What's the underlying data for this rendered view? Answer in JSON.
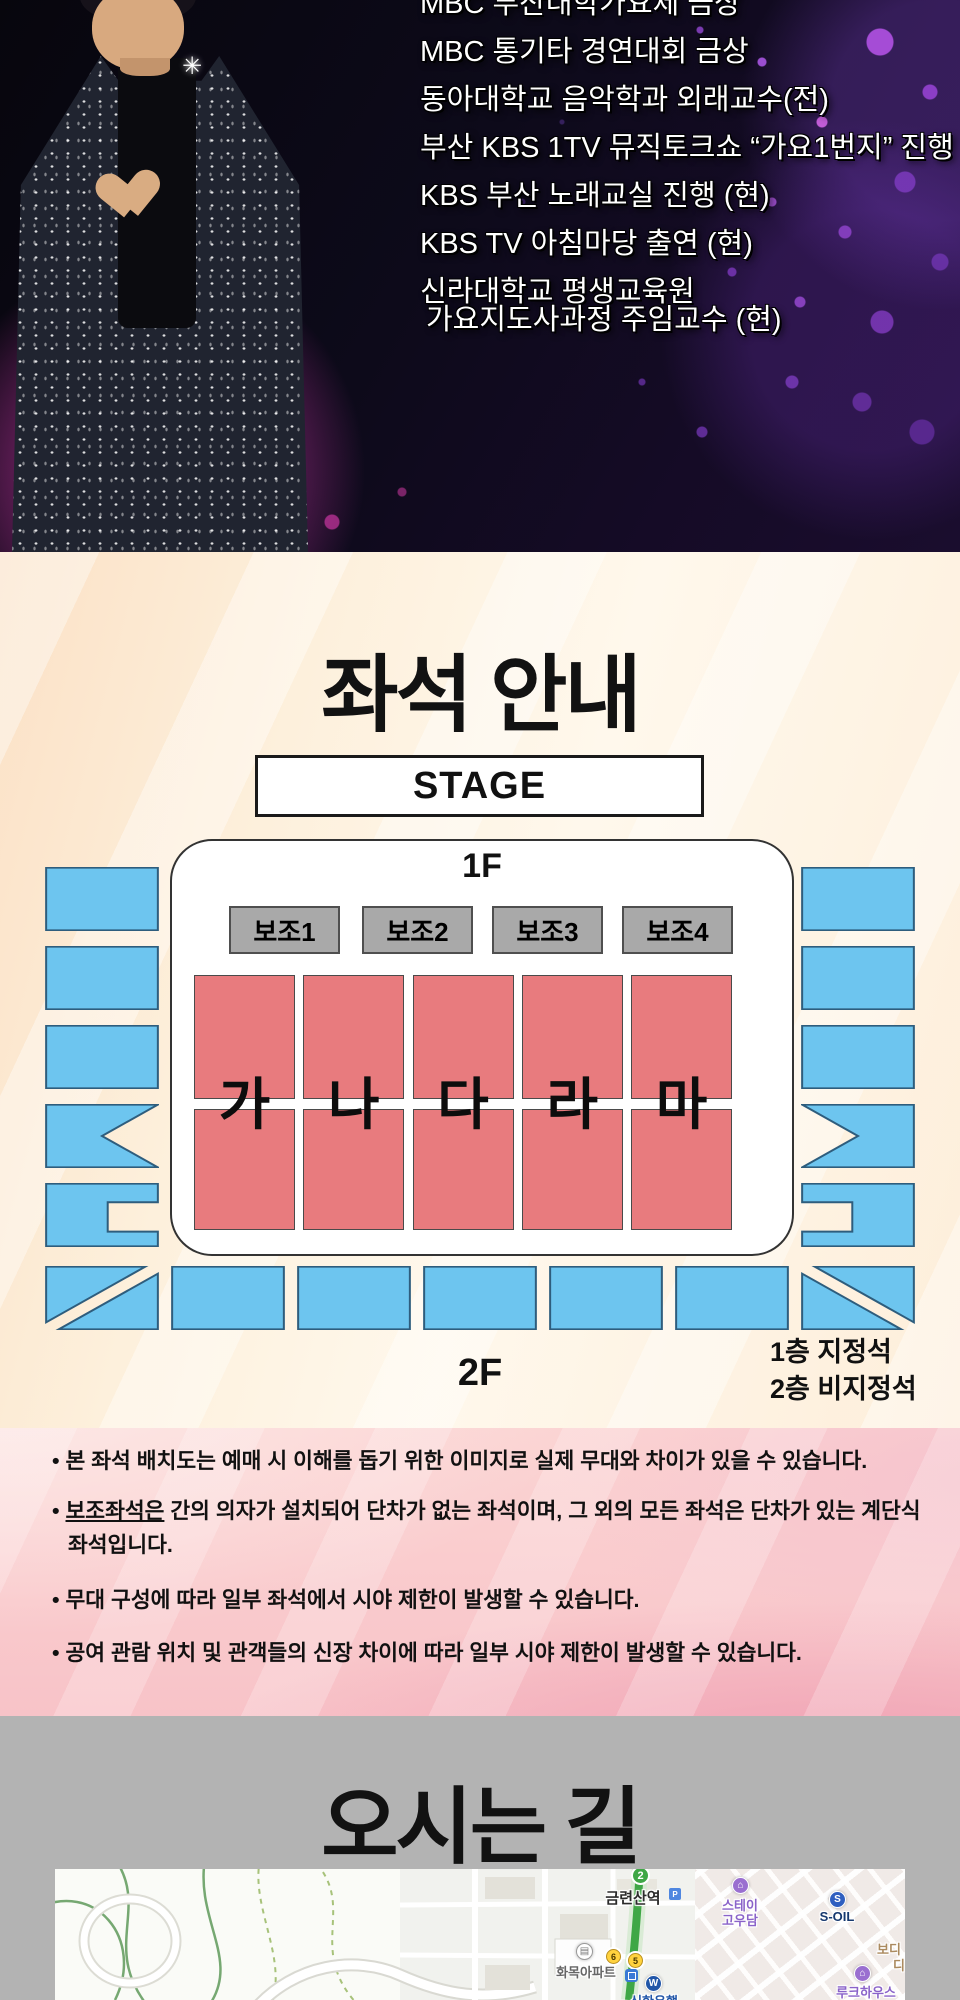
{
  "hero": {
    "credentials": [
      "MBC 부산대학가요제 금상",
      "MBC 통기타 경연대회 금상",
      "동아대학교 음악학과 외래교수(전)",
      "부산 KBS 1TV 뮤직토크쇼 “가요1번지” 진행",
      "KBS 부산 노래교실 진행 (현)",
      "KBS TV 아침마당 출연 (현)",
      "신라대학교 평생교육원",
      "가요지도사과정 주임교수 (현)"
    ]
  },
  "seating": {
    "title": "좌석 안내",
    "stage": "STAGE",
    "floor1": "1F",
    "floor2": "2F",
    "aux": [
      "보조1",
      "보조2",
      "보조3",
      "보조4"
    ],
    "sections": [
      "가",
      "나",
      "다",
      "라",
      "마"
    ],
    "legend": [
      "1층 지정석",
      "2층 비지정석"
    ],
    "colors": {
      "reserved_section": "#e87b7e",
      "unreserved_section": "#6dc5ef",
      "aux_section": "#a9a9a9",
      "hall_border": "#333333"
    }
  },
  "notices": [
    {
      "lead": "",
      "text": "본 좌석 배치도는 예매 시 이해를 돕기 위한 이미지로 실제 무대와 차이가 있을 수 있습니다."
    },
    {
      "lead": "보조좌석은",
      "text": " 간의 의자가 설치되어 단차가 없는 좌석이며, 그 외의 모든 좌석은 단차가 있는 계단식 좌석입니다."
    },
    {
      "lead": "",
      "text": "무대 구성에 따라 일부 좌석에서 시야 제한이 발생할 수 있습니다."
    },
    {
      "lead": "",
      "text": "공여 관람 위치 및 관객들의 신장 차이에 따라 일부 시야 제한이 발생할 수 있습니다."
    }
  ],
  "directions": {
    "title": "오시는 길"
  },
  "map": {
    "subway_badge": "2",
    "station": "금련산역",
    "parking_icon": "P",
    "bus1": "6",
    "bus2": "5",
    "apartment": "화목아파트",
    "bank": "신한은행",
    "stay1": "스테이",
    "stay2": "고우담",
    "soil": "S-OIL",
    "lodging": "루크하우스",
    "clipped1": "보디",
    "clipped2": "디",
    "subway_line_color": "#3fa746"
  }
}
